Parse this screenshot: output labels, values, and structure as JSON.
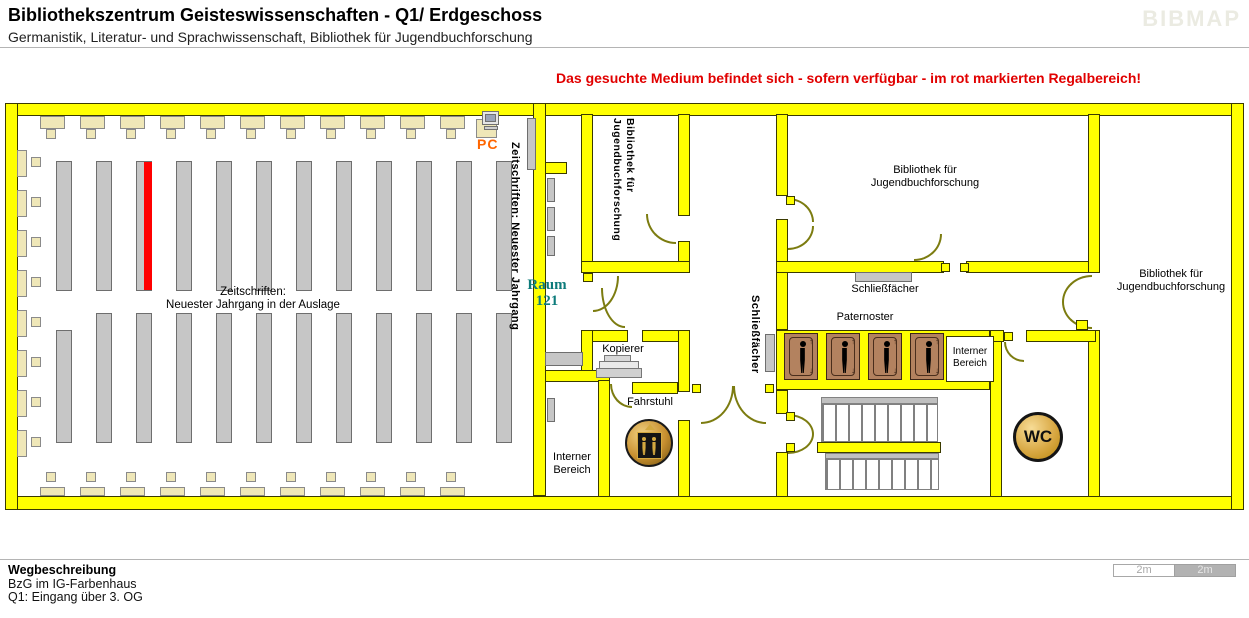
{
  "colors": {
    "wall": "#FFFF00",
    "highlight_shelf": "#FF0000",
    "shelf": "#C6C6C6",
    "display_shelf": "#EFE7B8",
    "notice_text": "#E10000",
    "room_number_text": "#0D7B7B",
    "pc_label": "#FF6600",
    "paternoster_cabin": "#B3825F",
    "wc_gold": "#D9A945",
    "door_arc": "#7C7C10"
  },
  "header": {
    "title": "Bibliothekszentrum Geisteswissenschaften - Q1/ Erdgeschoss",
    "subtitle": "Germanistik, Literatur- und Sprachwissenschaft, Bibliothek für Jugendbuchforschung",
    "logo": "BIBMAP"
  },
  "notice": {
    "text": "Das gesuchte Medium befindet sich - sofern verfügbar -  im rot markierten Regalbereich!"
  },
  "map": {
    "labels": {
      "pc": "PC",
      "periodicals_vertical": "Zeitschriften: Neuester Jahrgang",
      "periodicals_display": [
        "Zeitschriften:",
        "Neuester Jahrgang in der Auslage"
      ],
      "room_number": [
        "Raum",
        "121"
      ],
      "youth_library_small": [
        "Bibliothek für",
        "Jugendbuchforschung"
      ],
      "youth_library_top": [
        "Bibliothek für",
        "Jugendbuchforschung"
      ],
      "youth_library_right": [
        "Bibliothek für",
        "Jugendbuchforschung"
      ],
      "lockers_top": "Schließfächer",
      "lockers_vertical": "Schließfächer",
      "paternoster": "Paternoster",
      "copier": "Kopierer",
      "elevator": "Fahrstuhl",
      "staff_area_left": [
        "Interner",
        "Bereich"
      ],
      "staff_area_right": [
        "Interner",
        "Bereich"
      ],
      "wc": "WC"
    }
  },
  "footer": {
    "heading": "Wegbeschreibung",
    "building": "BzG im IG-Farbenhaus",
    "entrance": "Q1: Eingang über 3. OG"
  },
  "scalebar": {
    "left": "2m",
    "right": "2m"
  }
}
